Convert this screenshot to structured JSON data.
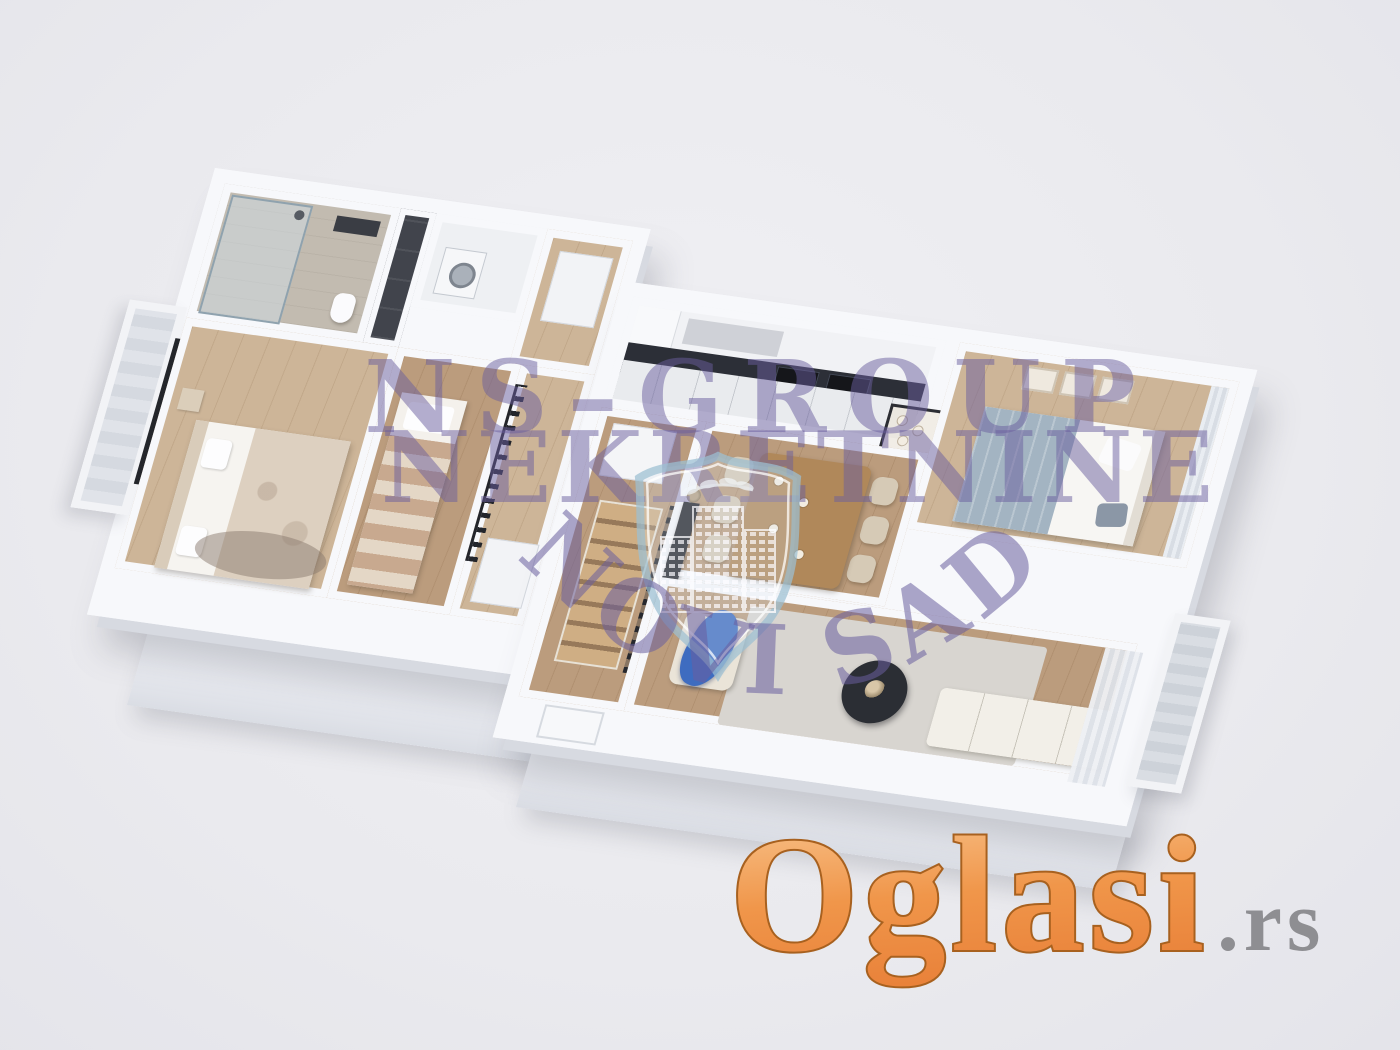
{
  "image": {
    "kind": "real-estate-listing-3d-floorplan-render",
    "background": "#eaeaee",
    "width": 1400,
    "height": 1050
  },
  "watermark": {
    "line1": "NS–GROUP",
    "line2": "NEKRETNINE",
    "arc": "NOVI SAD",
    "color": "#695e9e",
    "shield_stroke": "#9cc0d2"
  },
  "brand": {
    "name": "Oglasi",
    "tld": ".rs",
    "orange_light": "#f9c893",
    "orange_mid": "#f0964a",
    "orange_dark": "#e9823a",
    "outline": "#a8611f",
    "tld_color": "#8e8e92"
  },
  "floorplan": {
    "colors": {
      "wall": "#f7f8fb",
      "wall_shade": "#d7dae1",
      "floor_wood": "#bb9c7d",
      "floor_wood_light": "#cdb598",
      "bathroom_tile": "#c2bbb0",
      "dark_furniture": "#2c2f36",
      "kitchen_backsplash": "#2c2f37",
      "accent_blue": "#3e6cc0"
    },
    "rooms": [
      {
        "name": "bathroom",
        "furniture": [
          "shower",
          "toilet",
          "sink"
        ]
      },
      {
        "name": "laundry-closet",
        "furniture": [
          "washing-machine"
        ]
      },
      {
        "name": "master-bedroom",
        "furniture": [
          "double-bed",
          "nightstand",
          "rug"
        ]
      },
      {
        "name": "second-bedroom",
        "furniture": [
          "single-bed"
        ]
      },
      {
        "name": "hallway",
        "furniture": [
          "wardrobe",
          "glass-partition",
          "doors"
        ]
      },
      {
        "name": "staircase-hall",
        "furniture": [
          "staircase",
          "railing",
          "closet"
        ]
      },
      {
        "name": "kitchen",
        "furniture": [
          "cabinets",
          "fridge",
          "cooktops",
          "backsplash"
        ]
      },
      {
        "name": "dining-area",
        "furniture": [
          "dining-table",
          "six-chairs",
          "display-cabinet"
        ]
      },
      {
        "name": "bedroom",
        "furniture": [
          "bed",
          "picture-frames",
          "curtains"
        ]
      },
      {
        "name": "living-room",
        "furniture": [
          "armchair",
          "blue-throw",
          "coffee-table",
          "sofa",
          "rug",
          "media-console",
          "curtains"
        ]
      },
      {
        "name": "balcony-left",
        "furniture": []
      },
      {
        "name": "balcony-right",
        "furniture": []
      }
    ]
  }
}
